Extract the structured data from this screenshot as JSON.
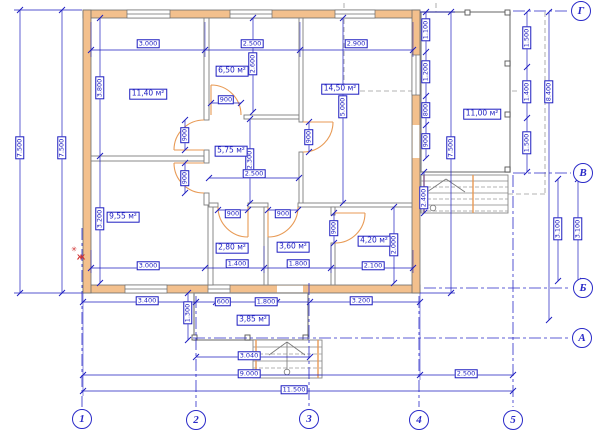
{
  "drawing": {
    "type": "architectural-floor-plan",
    "area_unit": "м²"
  },
  "colors": {
    "dim_blue": "#1d1dc0",
    "axis_blue": "#2a2ac8",
    "wall_fill": "#f3c08d",
    "wall_stroke": "#6b6b6b",
    "partition_gray": "#7d7d7d",
    "door_orange": "#e89a55",
    "dashed_gray": "#9a9a9a",
    "mark_red": "#d03030"
  },
  "dim_labels": [
    {
      "text": "3.000",
      "x": 148,
      "y": 44
    },
    {
      "text": "2.500",
      "x": 252,
      "y": 44
    },
    {
      "text": "2.900",
      "x": 356,
      "y": 44
    },
    {
      "text": "7.500",
      "x": 20,
      "y": 148,
      "rot": 1
    },
    {
      "text": "7.500",
      "x": 62,
      "y": 148,
      "rot": 1
    },
    {
      "text": "3.800",
      "x": 100,
      "y": 88,
      "rot": 1
    },
    {
      "text": "3.200",
      "x": 100,
      "y": 219,
      "rot": 1
    },
    {
      "text": "2.600",
      "x": 253,
      "y": 64,
      "rot": 1
    },
    {
      "text": "900",
      "x": 226,
      "y": 100
    },
    {
      "text": "2.300",
      "x": 250,
      "y": 160,
      "rot": 1
    },
    {
      "text": "2.500",
      "x": 254,
      "y": 174
    },
    {
      "text": "900",
      "x": 185,
      "y": 135,
      "rot": 1
    },
    {
      "text": "900",
      "x": 185,
      "y": 178,
      "rot": 1
    },
    {
      "text": "900",
      "x": 309,
      "y": 137,
      "rot": 1
    },
    {
      "text": "5.000",
      "x": 343,
      "y": 107,
      "rot": 1
    },
    {
      "text": "900",
      "x": 233,
      "y": 214
    },
    {
      "text": "900",
      "x": 283,
      "y": 214
    },
    {
      "text": "900",
      "x": 334,
      "y": 228,
      "rot": 1
    },
    {
      "text": "2.000",
      "x": 394,
      "y": 245,
      "rot": 1
    },
    {
      "text": "3.000",
      "x": 148,
      "y": 266
    },
    {
      "text": "1.400",
      "x": 237,
      "y": 264
    },
    {
      "text": "1.800",
      "x": 298,
      "y": 264
    },
    {
      "text": "2.100",
      "x": 373,
      "y": 266
    },
    {
      "text": "1.100",
      "x": 426,
      "y": 30,
      "rot": 1
    },
    {
      "text": "1.200",
      "x": 426,
      "y": 72,
      "rot": 1
    },
    {
      "text": "800",
      "x": 426,
      "y": 110,
      "rot": 1
    },
    {
      "text": "900",
      "x": 426,
      "y": 141,
      "rot": 1
    },
    {
      "text": "2.400",
      "x": 424,
      "y": 198,
      "rot": 1
    },
    {
      "text": "7.500",
      "x": 451,
      "y": 148,
      "rot": 1
    },
    {
      "text": "1.500",
      "x": 527,
      "y": 38,
      "rot": 1
    },
    {
      "text": "1.400",
      "x": 527,
      "y": 92,
      "rot": 1
    },
    {
      "text": "1.500",
      "x": 527,
      "y": 143,
      "rot": 1
    },
    {
      "text": "8.400",
      "x": 549,
      "y": 92,
      "rot": 1
    },
    {
      "text": "3.100",
      "x": 558,
      "y": 229,
      "rot": 1
    },
    {
      "text": "3.100",
      "x": 578,
      "y": 229,
      "rot": 1
    },
    {
      "text": "3.400",
      "x": 147,
      "y": 301
    },
    {
      "text": "600",
      "x": 223,
      "y": 302
    },
    {
      "text": "1.800",
      "x": 266,
      "y": 302
    },
    {
      "text": "3.200",
      "x": 361,
      "y": 301
    },
    {
      "text": "1.300",
      "x": 188,
      "y": 313,
      "rot": 1
    },
    {
      "text": "3.040",
      "x": 249,
      "y": 356
    },
    {
      "text": "9.000",
      "x": 249,
      "y": 374
    },
    {
      "text": "2.500",
      "x": 466,
      "y": 374
    },
    {
      "text": "11.500",
      "x": 294,
      "y": 390
    }
  ],
  "room_labels": [
    {
      "text": "11,40 м²",
      "x": 148,
      "y": 94
    },
    {
      "text": "6,50 м²",
      "x": 232,
      "y": 71
    },
    {
      "text": "14,50 м²",
      "x": 340,
      "y": 89
    },
    {
      "text": "5,75 м²",
      "x": 231,
      "y": 151
    },
    {
      "text": "9,55 м²",
      "x": 123,
      "y": 217
    },
    {
      "text": "2,80 м²",
      "x": 232,
      "y": 248
    },
    {
      "text": "3,60 м²",
      "x": 293,
      "y": 247
    },
    {
      "text": "4,20 м²",
      "x": 374,
      "y": 241
    },
    {
      "text": "11,00 м²",
      "x": 482,
      "y": 114
    },
    {
      "text": "3,85 м²",
      "x": 253,
      "y": 320
    }
  ],
  "axis_circles": [
    {
      "label": "Г",
      "x": 581,
      "y": 11
    },
    {
      "label": "В",
      "x": 583,
      "y": 173
    },
    {
      "label": "Б",
      "x": 583,
      "y": 288
    },
    {
      "label": "А",
      "x": 582,
      "y": 338
    },
    {
      "label": "1",
      "x": 82,
      "y": 419
    },
    {
      "label": "2",
      "x": 196,
      "y": 420
    },
    {
      "label": "3",
      "x": 309,
      "y": 419
    },
    {
      "label": "4",
      "x": 419,
      "y": 420
    },
    {
      "label": "5",
      "x": 513,
      "y": 420
    }
  ],
  "red_marks": [
    {
      "text": "✳",
      "x": 74,
      "y": 250
    },
    {
      "text": "Ж",
      "x": 81,
      "y": 258
    }
  ],
  "tick_marks": [
    [
      91,
      50
    ],
    [
      205,
      50
    ],
    [
      300,
      50
    ],
    [
      413,
      50
    ],
    [
      20,
      10
    ],
    [
      20,
      293
    ],
    [
      62,
      10
    ],
    [
      62,
      293
    ],
    [
      100,
      18
    ],
    [
      100,
      156
    ],
    [
      100,
      283
    ],
    [
      253,
      18
    ],
    [
      253,
      112
    ],
    [
      211,
      103
    ],
    [
      241,
      103
    ],
    [
      250,
      119
    ],
    [
      250,
      203
    ],
    [
      209,
      178
    ],
    [
      299,
      178
    ],
    [
      185,
      120
    ],
    [
      185,
      150
    ],
    [
      185,
      163
    ],
    [
      185,
      193
    ],
    [
      309,
      122
    ],
    [
      309,
      152
    ],
    [
      343,
      18
    ],
    [
      343,
      203
    ],
    [
      218,
      210
    ],
    [
      248,
      210
    ],
    [
      268,
      210
    ],
    [
      298,
      210
    ],
    [
      334,
      213
    ],
    [
      334,
      243
    ],
    [
      394,
      207
    ],
    [
      394,
      283
    ],
    [
      91,
      268
    ],
    [
      205,
      268
    ],
    [
      264,
      268
    ],
    [
      331,
      268
    ],
    [
      413,
      268
    ],
    [
      426,
      12
    ],
    [
      426,
      52
    ],
    [
      426,
      96
    ],
    [
      426,
      125
    ],
    [
      426,
      158
    ],
    [
      424,
      172
    ],
    [
      424,
      213
    ],
    [
      451,
      12
    ],
    [
      451,
      293
    ],
    [
      527,
      12
    ],
    [
      527,
      67
    ],
    [
      527,
      118
    ],
    [
      527,
      172
    ],
    [
      549,
      12
    ],
    [
      549,
      320
    ],
    [
      558,
      179
    ],
    [
      558,
      281
    ],
    [
      578,
      179
    ],
    [
      578,
      281
    ],
    [
      83,
      302
    ],
    [
      196,
      302
    ],
    [
      216,
      302
    ],
    [
      277,
      302
    ],
    [
      310,
      302
    ],
    [
      420,
      302
    ],
    [
      188,
      293
    ],
    [
      188,
      340
    ],
    [
      196,
      357
    ],
    [
      310,
      357
    ],
    [
      83,
      375
    ],
    [
      420,
      375
    ],
    [
      513,
      375
    ],
    [
      83,
      391
    ],
    [
      513,
      391
    ]
  ]
}
